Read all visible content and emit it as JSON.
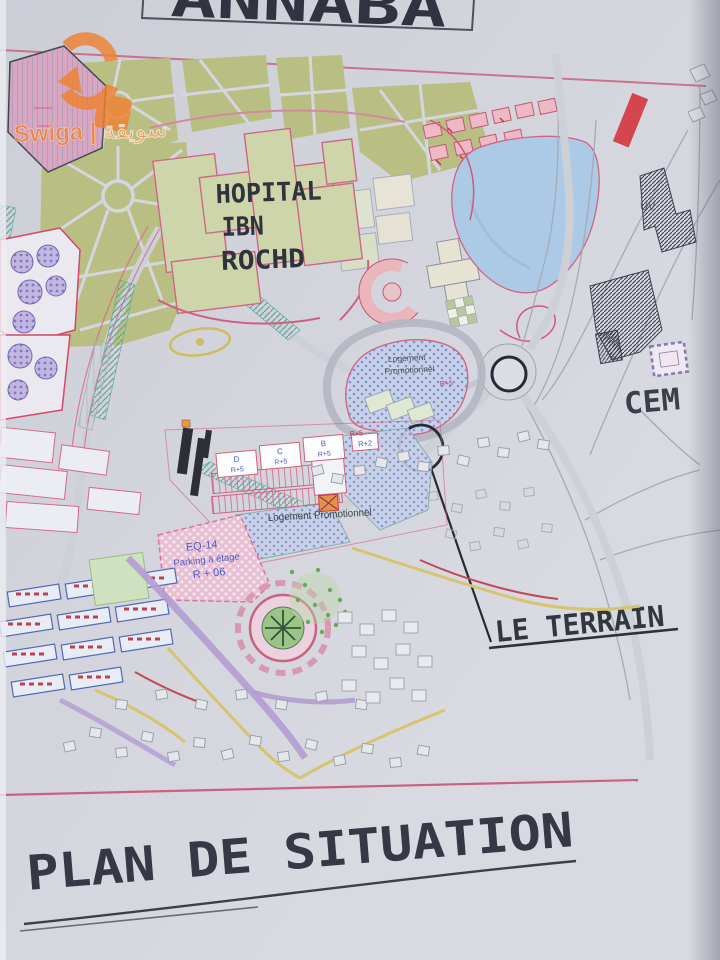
{
  "watermark": {
    "brand_text": "Swiga | سويقة"
  },
  "title_box": {
    "label": "ANNABA"
  },
  "map": {
    "hospital": {
      "line1": "HOPITAL",
      "line2": "IBN",
      "line3": "ROCHD"
    },
    "cem_label": "CEM",
    "uv_label": "UV",
    "logement_upper": {
      "line1": "Logement",
      "line2": "Promotionnel"
    },
    "logement_lower_label": "Logement Promotionnel",
    "terrain_label": "LE TERRAIN",
    "parking_block": {
      "line1": "EQ-14",
      "line2": "Parking à étage",
      "line3": "R + 06"
    },
    "blocks": [
      {
        "name": "D",
        "floors": "R+5"
      },
      {
        "name": "C",
        "floors": "R+5"
      },
      {
        "name": "B",
        "floors": "R+5"
      }
    ],
    "annex_floors_label": "R+2",
    "floor_mark": "R+5"
  },
  "footer": {
    "title": "PLAN DE SITUATION"
  },
  "colors": {
    "accent_pink": "#c9627f",
    "park_green": "#b9bf82",
    "zone_blue": "#c7d1ea",
    "lake_blue": "#accae6",
    "ink": "#30343e",
    "watermark_orange": "#ef8132",
    "red_bar": "#d4454d"
  }
}
